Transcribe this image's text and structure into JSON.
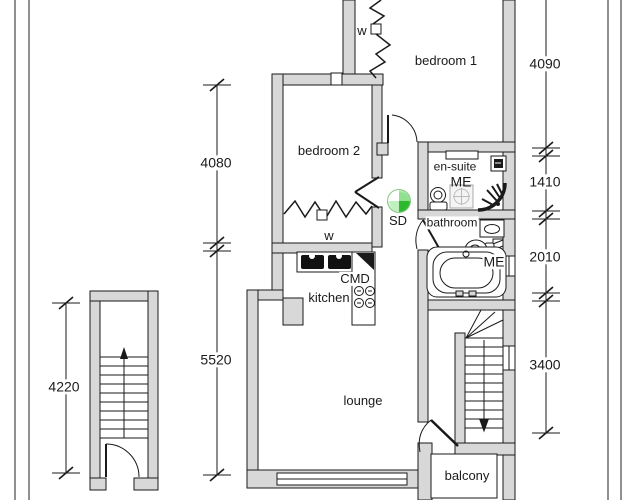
{
  "drawing": {
    "type": "floor-plan",
    "labels": {
      "bedroom1": "bedroom 1",
      "bedroom2": "bedroom 2",
      "ensuite": "en-suite",
      "bathroom": "bathroom",
      "kitchen": "kitchen",
      "lounge": "lounge",
      "balcony": "balcony",
      "wardrobe1": "w",
      "wardrobe2": "w",
      "smoke_detector": "SD",
      "me_ensuite": "ME",
      "me_bathroom": "ME",
      "cooker_cmd": "CMD"
    },
    "dimensions": {
      "right": [
        "4090",
        "1410",
        "2010",
        "3400"
      ],
      "left": [
        "4080",
        "5520"
      ],
      "communal_stairs": "4220"
    },
    "colors": {
      "wall_fill": "#d8d8d8",
      "line": "#1a1a1a",
      "smoke_detector_green": "#2eb82e"
    }
  }
}
